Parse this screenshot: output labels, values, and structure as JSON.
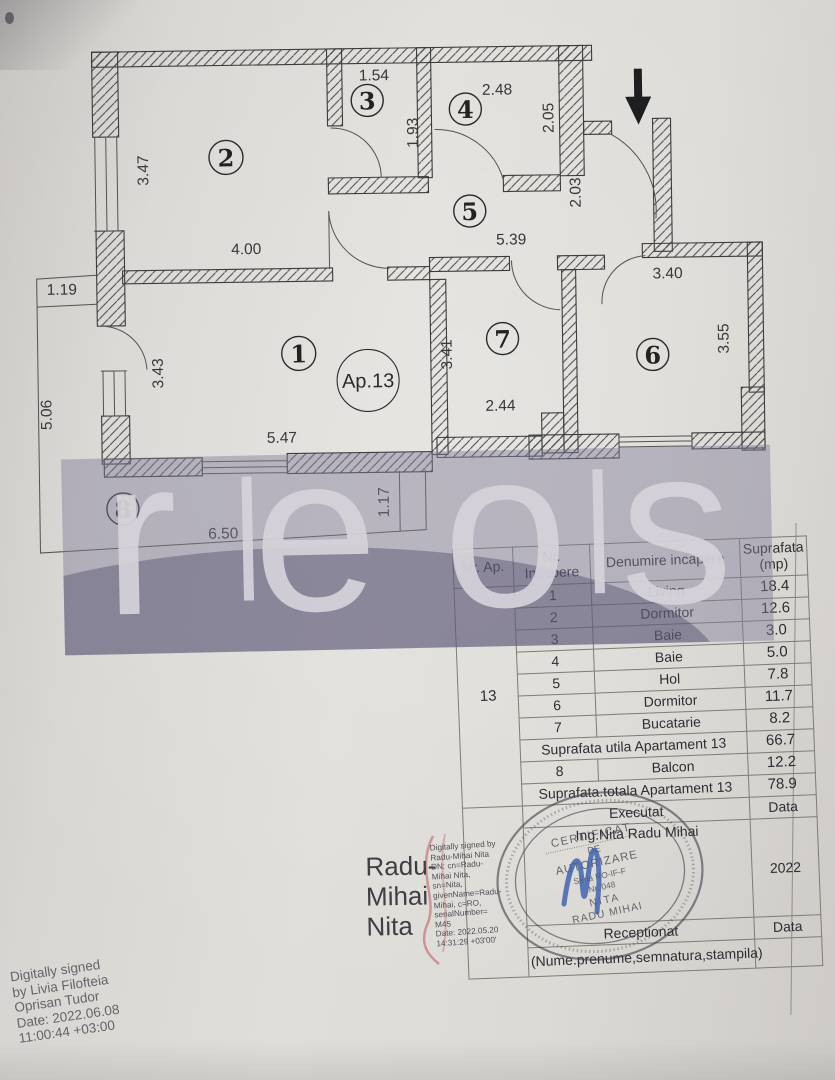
{
  "plan": {
    "apartment_label": "Ap.13",
    "rooms": [
      {
        "number": "1"
      },
      {
        "number": "2"
      },
      {
        "number": "3"
      },
      {
        "number": "4"
      },
      {
        "number": "5"
      },
      {
        "number": "6"
      },
      {
        "number": "7"
      },
      {
        "number": "8"
      }
    ],
    "dimensions": [
      "3.47",
      "4.00",
      "1.54",
      "1.93",
      "2.48",
      "2.05",
      "5.39",
      "2.03",
      "3.43",
      "5.47",
      "3.41",
      "2.44",
      "3.40",
      "3.55",
      "1.19",
      "5.06",
      "6.50",
      "1.17"
    ]
  },
  "watermark": {
    "letters": [
      "r",
      "e",
      "o",
      "s"
    ]
  },
  "table": {
    "header_nr_ap": "Nr. Ap.",
    "header_nr_incapere_1": "Nr.",
    "header_nr_incapere_2": "Incapere",
    "header_denumire": "Denumire incapere",
    "header_suprafata_1": "Suprafata",
    "header_suprafata_2": "(mp)",
    "apartment_number": "13",
    "rows": [
      {
        "nr": "1",
        "name": "Living",
        "area": "18.4"
      },
      {
        "nr": "2",
        "name": "Dormitor",
        "area": "12.6"
      },
      {
        "nr": "3",
        "name": "Baie",
        "area": "3.0"
      },
      {
        "nr": "4",
        "name": "Baie",
        "area": "5.0"
      },
      {
        "nr": "5",
        "name": "Hol",
        "area": "7.8"
      },
      {
        "nr": "6",
        "name": "Dormitor",
        "area": "11.7"
      },
      {
        "nr": "7",
        "name": "Bucatarie",
        "area": "8.2"
      }
    ],
    "summary_utila_label": "Suprafata utila Apartament 13",
    "summary_utila_value": "66.7",
    "balcon_nr": "8",
    "balcon_name": "Balcon",
    "balcon_area": "12.2",
    "summary_totala_label": "Suprafata.totala Apartament 13",
    "summary_totala_value": "78.9",
    "executat_label": "Executat",
    "executat_right": "Data",
    "executat_name": "Ing.Nita Radu Mihai",
    "year": "2022",
    "receptionat_label": "Receptionat",
    "receptionat_right": "Data",
    "nume_row": "(Nume.prenume,semnatura,stampila)"
  },
  "stamp": {
    "line1": "CERTIFICAT",
    "line2": "DE",
    "line3": "AUTORIZARE",
    "line4": "Seria RO-IF-F",
    "line5": "Nr. 048",
    "line6": "NITA",
    "line7": "RADU MIHAI"
  },
  "signatures": {
    "radu_big": [
      "Radu-",
      "Mihai",
      "Nita"
    ],
    "radu_details": [
      "Digitally signed by",
      "Radu-Mihai Nita",
      "DN: cn=Radu-",
      "Mihai Nita,",
      "sn=Nita,",
      "givenName=Radu-",
      "Mihai, c=RO,",
      "serialNumber=",
      "M45",
      "Date: 2022.05.20",
      "14:31:29 +03'00'"
    ],
    "livia": [
      "Digitally signed",
      "by Livia Filofteia",
      "Oprisan Tudor",
      "Date: 2022.06.08",
      "11:00:44 +03:00"
    ]
  }
}
